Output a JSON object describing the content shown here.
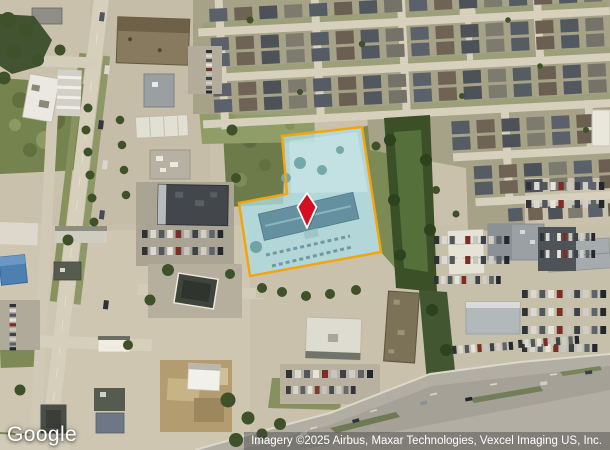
{
  "branding": {
    "logo_text": "Google"
  },
  "attribution": {
    "text": "Imagery ©2025 Airbus, Maxar Technologies, Vexcel Imaging US, Inc."
  },
  "map": {
    "view": "satellite",
    "parcel": {
      "outline_color": "#F2A50C",
      "fill_color": "rgba(173,220,228,0.78)",
      "marker": {
        "shape": "diamond-pin",
        "fill_color": "#D40F20",
        "outline_color": "#FFFFFF"
      }
    }
  }
}
